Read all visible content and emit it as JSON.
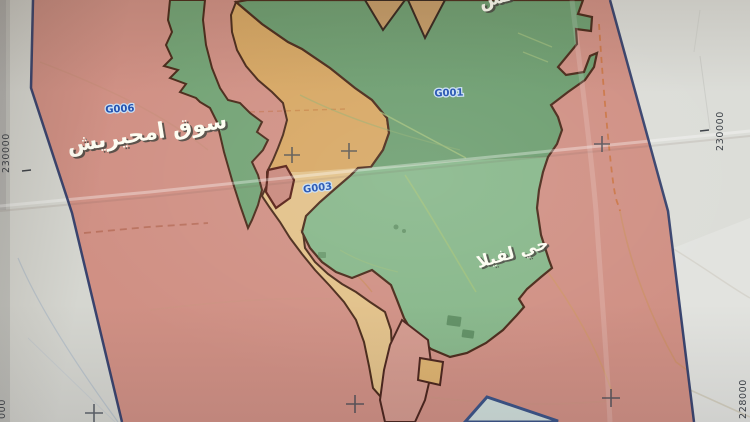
{
  "map": {
    "place_labels": [
      {
        "id": "souq",
        "text": "سوق امحيريش"
      },
      {
        "id": "villa",
        "text": "حي لفيلا"
      },
      {
        "id": "partial_top",
        "text": "لس"
      }
    ],
    "zone_codes": [
      {
        "id": "g006",
        "code": "G006"
      },
      {
        "id": "g001",
        "code": "G001"
      },
      {
        "id": "g003",
        "code": "G003"
      }
    ],
    "grid_coordinates": {
      "left": "230000",
      "right": "230000",
      "bottom_left": "000",
      "bottom_right": "228000"
    }
  },
  "colors": {
    "paper": "#d5d6d0",
    "paper_right": "#dcddd8",
    "paper_bright": "#e4e5e1",
    "zone_pink": "#d09084",
    "zone_green_upper": "#6d9e70",
    "zone_green_lower": "#87b78a",
    "zone_green_strip": "#73a375",
    "zone_tan_upper": "#d7a763",
    "zone_tan_lower": "#e2c189",
    "zone_tan_triangle": "#c59b66",
    "zone_border": "#4a2a1a",
    "neatline_blue": "#2b3a68",
    "code_blue": "#2050b0",
    "label_white": "#fdfdf2",
    "parcel_light": "#cfdeda",
    "parcel_border": "#3a5387",
    "red_parcel_border": "#571f15"
  }
}
